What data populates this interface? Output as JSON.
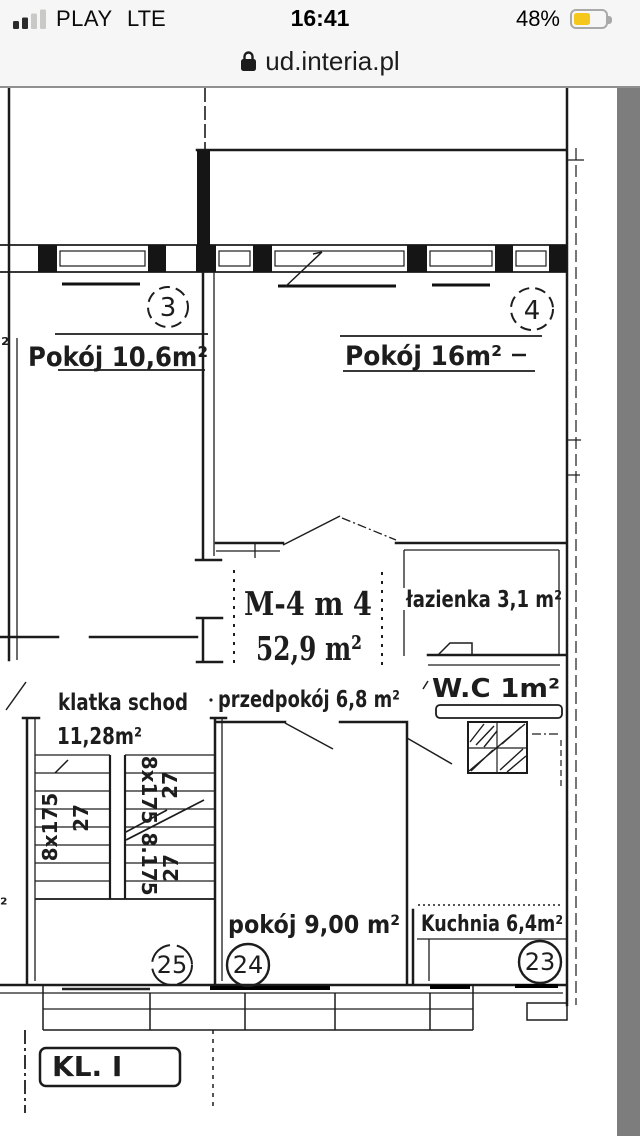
{
  "status_bar": {
    "carrier": "PLAY",
    "network": "LTE",
    "time": "16:41",
    "battery_percent": "48%",
    "battery_color": "#F5C71C"
  },
  "url_bar": {
    "url": "ud.interia.pl"
  },
  "floor_plan": {
    "unit_label": {
      "line1": "M-4 m 4",
      "line2": "52,9 m²"
    },
    "rooms": {
      "pokoj_a": {
        "number": "3",
        "label": "Pokój 10,6m²"
      },
      "pokoj_b": {
        "number": "4",
        "label": "Pokój 16m²"
      },
      "lazienka": {
        "label": "łazienka 3,1 m²"
      },
      "wc": {
        "label": "W.C 1m²"
      },
      "przedpokoj": {
        "label": "przedpokój 6,8 m²"
      },
      "klatka": {
        "name": "klatka schod",
        "area": "11,28m²"
      },
      "pokoj_c": {
        "number": "24",
        "label": "pokój 9,00 m²"
      },
      "kuchnia": {
        "number": "23",
        "label": "Kuchnia 6,4m²"
      },
      "stairwell_number": "25"
    },
    "stairs": {
      "left": {
        "steps": "8x175",
        "depth": "27"
      },
      "right_upper": {
        "steps": "8x175",
        "depth": "27"
      },
      "right_lower": {
        "steps": "8.175",
        "depth": "27"
      }
    },
    "staircase_id": "KL. I",
    "edge_fragments": {
      "top": "²",
      "bottom": "²"
    }
  }
}
